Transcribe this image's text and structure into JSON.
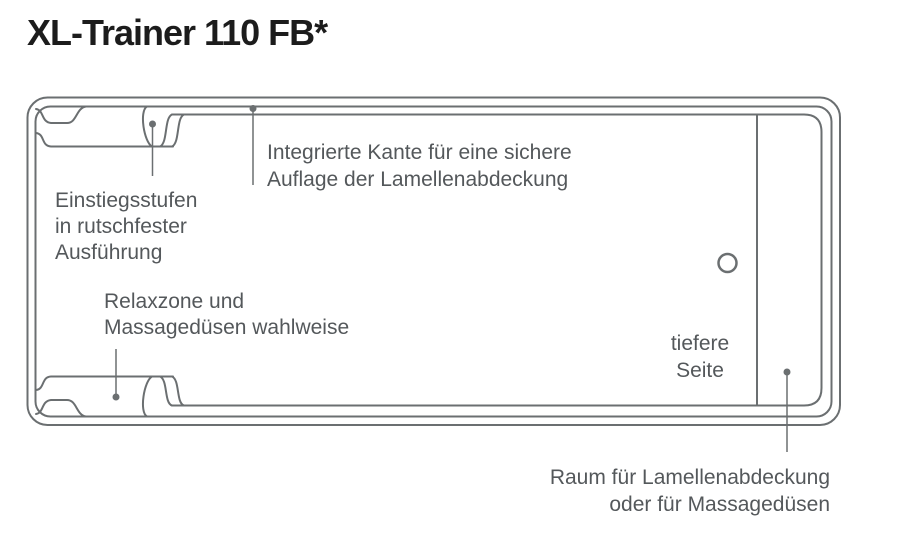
{
  "title": "XL-Trainer 110 FB*",
  "colors": {
    "line_color": "#6b6f71",
    "label_text": "#54585b",
    "title_text": "#1c1c1c",
    "background": "#ffffff"
  },
  "diagram": {
    "description": "top-view pool shell drawing",
    "labels": {
      "integrated_edge": {
        "line1": "Integrierte Kante für eine sichere",
        "line2": "Auflage der Lamellenabdeckung"
      },
      "entry_steps": {
        "line1": "Einstiegsstufen",
        "line2": "in rutschfester",
        "line3": "Ausführung"
      },
      "relax_zone": {
        "line1": "Relaxzone und",
        "line2": "Massagedüsen wahlweise"
      },
      "deeper_side": {
        "line1": "tiefere",
        "line2": "Seite"
      },
      "cover_space": {
        "line1": "Raum für Lamellenabdeckung",
        "line2": "oder für Massagedüsen"
      }
    }
  }
}
